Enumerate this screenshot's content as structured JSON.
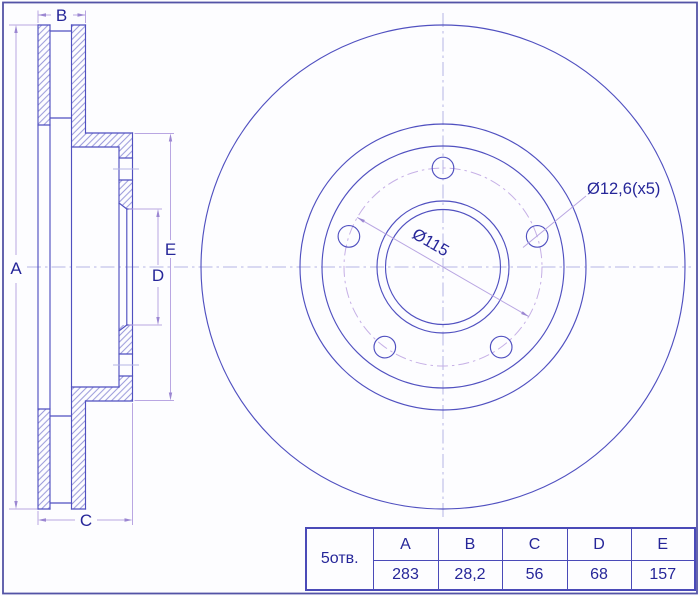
{
  "section_view": {
    "dim_a": "A",
    "dim_b": "B",
    "dim_c": "C",
    "dim_d": "D",
    "dim_e": "E"
  },
  "front_view": {
    "bolt_circle_dim": "Ø115",
    "bolt_holes_callout": "Ø12,6(x5)"
  },
  "spec_table": {
    "row_header": "5отв.",
    "columns": [
      "A",
      "B",
      "C",
      "D",
      "E"
    ],
    "values": [
      "283",
      "28,2",
      "56",
      "68",
      "157"
    ]
  },
  "colors": {
    "outline": "#5050c0",
    "dimension": "#b9a6e2",
    "centerline": "#b5b5e5",
    "hatch": "#8585d2",
    "text": "#262699",
    "table_border": "#4a4ab8",
    "background": "#fdfdff"
  }
}
